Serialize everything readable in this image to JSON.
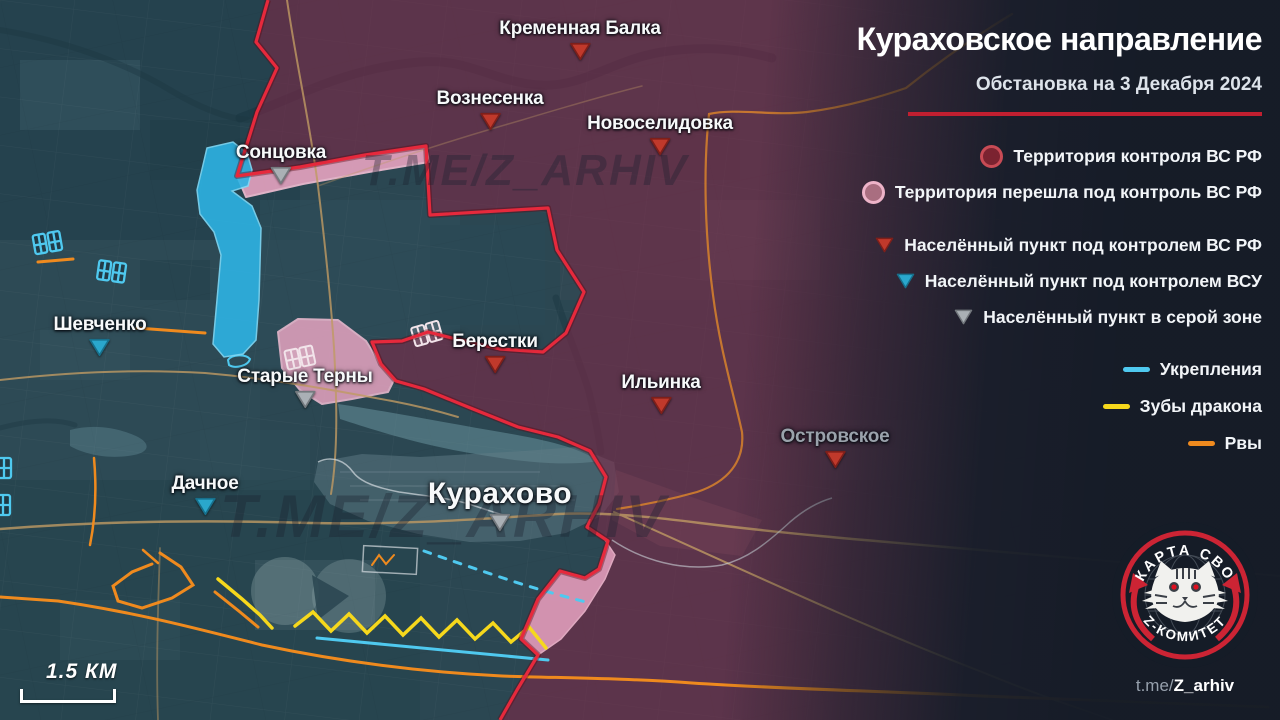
{
  "header": {
    "title": "Кураховское направление",
    "subtitle": "Обстановка на 3 Декабря 2024"
  },
  "legend": {
    "areas": [
      {
        "label": "Территория контроля ВС РФ",
        "marker": "circle-red"
      },
      {
        "label": "Территория перешла под контроль ВС РФ",
        "marker": "circle-pink"
      }
    ],
    "settlements": [
      {
        "label": "Населённый пункт под контролем ВС РФ",
        "marker": "triangle-red"
      },
      {
        "label": "Населённый пункт под контролем ВСУ",
        "marker": "triangle-cyan"
      },
      {
        "label": "Населённый пункт в серой зоне",
        "marker": "triangle-gray"
      }
    ],
    "lines": [
      {
        "label": "Укрепления",
        "marker": "line-cyan"
      },
      {
        "label": "Зубы дракона",
        "marker": "line-yellow"
      },
      {
        "label": "Рвы",
        "marker": "line-orange"
      }
    ]
  },
  "map": {
    "watermark": "T.ME/Z_ARHIV",
    "scale_label": "1.5 КМ",
    "towns": [
      {
        "name": "Кременная Балка",
        "x": 580,
        "y": 31,
        "marker": "red"
      },
      {
        "name": "Вознесенка",
        "x": 490,
        "y": 101,
        "marker": "red"
      },
      {
        "name": "Новоселидовка",
        "x": 660,
        "y": 126,
        "marker": "red"
      },
      {
        "name": "Сонцовка",
        "x": 281,
        "y": 155,
        "marker": "gray"
      },
      {
        "name": "Шевченко",
        "x": 100,
        "y": 327,
        "marker": "cyan"
      },
      {
        "name": "Старые Терны",
        "x": 305,
        "y": 379,
        "marker": "gray"
      },
      {
        "name": "Берестки",
        "x": 495,
        "y": 344,
        "marker": "red"
      },
      {
        "name": "Ильинка",
        "x": 661,
        "y": 385,
        "marker": "red"
      },
      {
        "name": "Островское",
        "x": 835,
        "y": 439,
        "marker": "red",
        "muted": true
      },
      {
        "name": "Дачное",
        "x": 205,
        "y": 486,
        "marker": "cyan"
      },
      {
        "name": "Курахово",
        "x": 500,
        "y": 497,
        "marker": "gray",
        "large": true
      }
    ]
  },
  "logo": {
    "top": "КАРТА СВО",
    "bottom": "Z-КОМИТЕТ"
  },
  "footer": {
    "prefix": "t.me/",
    "handle": "Z_arhiv"
  },
  "colors": {
    "accent_red": "#c11f30",
    "front_line": "#e6293c",
    "rf_area_circle": {
      "fill": "#7b2330",
      "stroke": "#c84b55"
    },
    "rf_new_circle": {
      "fill": "#a96e80",
      "stroke": "#edb3c8"
    },
    "tri_red": {
      "fill": "#c0392b",
      "stroke": "#7e1f1a"
    },
    "tri_cyan": {
      "fill": "#2aa7cc",
      "stroke": "#17708c"
    },
    "tri_gray": {
      "fill": "#aab0b5",
      "stroke": "#74797e"
    },
    "line_cyan": "#4fc9ef",
    "line_yellow": "#f6d81c",
    "line_orange": "#ef8a1e",
    "muted_label": "#9aa2ab"
  }
}
